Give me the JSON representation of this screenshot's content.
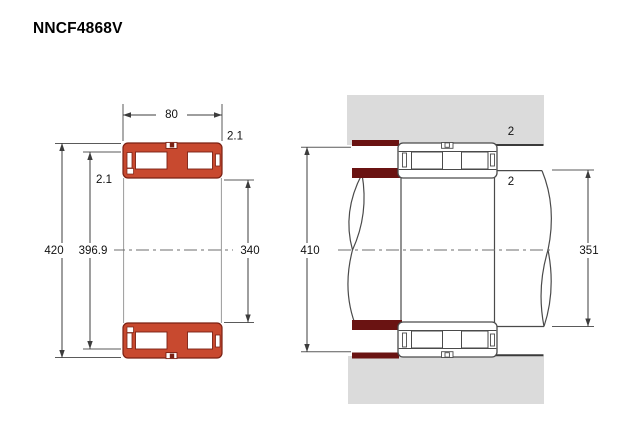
{
  "page": {
    "title": "NNCF4868V"
  },
  "left_view": {
    "name": "bearing-cross-section-view",
    "labels": {
      "width": "80",
      "outer_chamfer": "2.1",
      "inner_chamfer": "2.1",
      "outer_diameter": "420",
      "raceway_diameter": "396.9",
      "bore_diameter": "340"
    }
  },
  "right_view": {
    "name": "mounting-arrangement-view",
    "labels": {
      "housing_fillet_radius": "2",
      "shaft_fillet_radius": "2",
      "housing_abutment_diameter": "410",
      "shaft_abutment_diameter": "351"
    }
  },
  "colors": {
    "bearing_fill": "#c8492f",
    "bearing_outline": "#7a2113",
    "abutment_dark_red": "#6a1312",
    "housing_gray": "#dbdbdb",
    "drawing_line": "#4a4a4a"
  }
}
